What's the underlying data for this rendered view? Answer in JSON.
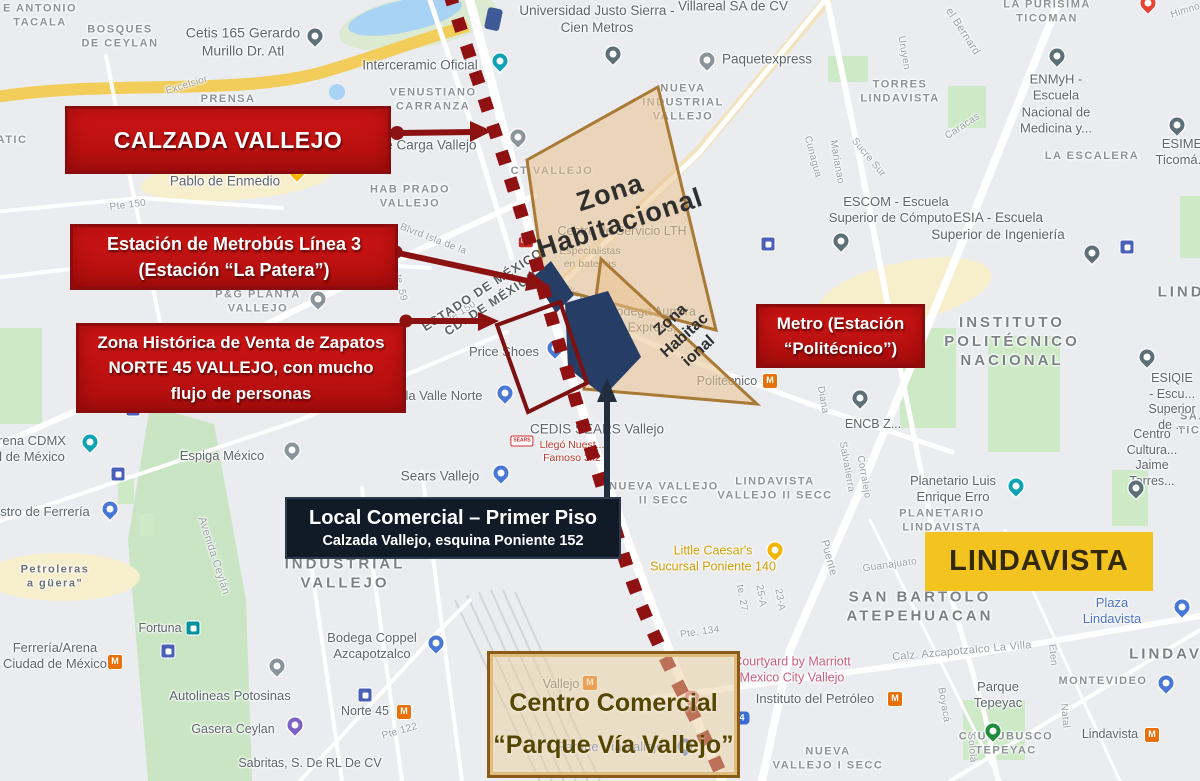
{
  "annotations": {
    "calzada_box": {
      "label": "CALZADA VALLEJO"
    },
    "metrobus_box": {
      "line1": "Estación de Metrobús Línea 3",
      "line2": "(Estación “La Patera”)"
    },
    "zona_historica_box": {
      "line1": "Zona Histórica de Venta de Zapatos",
      "line2": "NORTE 45 VALLEJO, con mucho",
      "line3": "flujo de personas"
    },
    "metro_box": {
      "line1": "Metro (Estación",
      "line2": "“Politécnico”)"
    },
    "local_box": {
      "line1": "Local Comercial – Primer Piso",
      "line2": "Calzada Vallejo, esquina Poniente 152"
    },
    "lindavista_box": {
      "label": "LINDAVISTA"
    },
    "centro_box": {
      "line1": "Centro Comercial",
      "line2": "“Parque Vía Vallejo”"
    },
    "zona_habitacional_1": "Zona\nHabitacional",
    "zona_habitacional_2": "Zona\nHabitac\nional"
  },
  "colors": {
    "callout_red": "#c01111",
    "callout_red_border": "#8a0c0c",
    "navy_box": "#111b28",
    "yellow_box": "#f3c41f",
    "zona_fill": "#e9c28f",
    "zona_border": "#a97a35",
    "dotted_line": "#8f1111",
    "station_blue": "#263d66",
    "metro_icon_orange": "#e8710a"
  },
  "map": {
    "labels": [
      {
        "t": "E ANTONIO\nTACALA",
        "x": 40,
        "y": 16,
        "k": "area"
      },
      {
        "t": "BOSQUES\nDE CEYLAN",
        "x": 120,
        "y": 37,
        "k": "area"
      },
      {
        "t": "ATIC",
        "x": 12,
        "y": 141,
        "k": "area"
      },
      {
        "t": "PRENSA",
        "x": 228,
        "y": 100,
        "k": "area"
      },
      {
        "t": "VENUSTIANO\nCARRANZA",
        "x": 433,
        "y": 100,
        "k": "area"
      },
      {
        "t": "HAB PRADO\nVALLEJO",
        "x": 410,
        "y": 197,
        "k": "area"
      },
      {
        "t": "CT VALLEJO",
        "x": 552,
        "y": 172,
        "k": "area"
      },
      {
        "t": "NUEVA\nINDUSTRIAL\nVALLEJO",
        "x": 683,
        "y": 103,
        "k": "area"
      },
      {
        "t": "TORRES\nLINDAVISTA",
        "x": 900,
        "y": 92,
        "k": "area"
      },
      {
        "t": "LA PURÍSIMA\nTICOMAN",
        "x": 1047,
        "y": 12,
        "k": "area"
      },
      {
        "t": "LA ESCALERA",
        "x": 1092,
        "y": 157,
        "k": "area"
      },
      {
        "t": "SA...\nTIC...",
        "x": 1196,
        "y": 424,
        "k": "area"
      },
      {
        "t": "LINDA",
        "x": 1188,
        "y": 293,
        "k": "area-lg"
      },
      {
        "t": "INSTITUTO\nPOLITÉCNICO\nNACIONAL",
        "x": 1012,
        "y": 342,
        "k": "area-lg"
      },
      {
        "t": "SAN BARTOLO\nATEPEHUACAN",
        "x": 920,
        "y": 607,
        "k": "area-lg"
      },
      {
        "t": "LINDAVISTA",
        "x": 1188,
        "y": 655,
        "k": "area-lg"
      },
      {
        "t": "INDUSTRIAL\nVALLEJO",
        "x": 345,
        "y": 574,
        "k": "area-lg"
      },
      {
        "t": "NUEVA VALLEJO\nII SECC",
        "x": 664,
        "y": 494,
        "k": "area"
      },
      {
        "t": "LINDAVISTA\nVALLEJO II SECC",
        "x": 775,
        "y": 489,
        "k": "area"
      },
      {
        "t": "PLANETARIO\nLINDAVISTA",
        "x": 942,
        "y": 521,
        "k": "area"
      },
      {
        "t": "MONTEVIDEO",
        "x": 1103,
        "y": 682,
        "k": "area"
      },
      {
        "t": "CHURUBUSCO\nTEPEYAC",
        "x": 1006,
        "y": 744,
        "k": "area"
      },
      {
        "t": "NUEVA\nVALLEJO I SECC",
        "x": 828,
        "y": 759,
        "k": "area"
      },
      {
        "t": "P&G PLANTA\nVALLEJO",
        "x": 258,
        "y": 302,
        "k": "area"
      },
      {
        "t": "Petroleras\na güera\"",
        "x": 55,
        "y": 577,
        "k": "area",
        "c": "#6d7276"
      },
      {
        "t": "Cetis 165 Gerardo\nMurillo Dr. Atl",
        "x": 243,
        "y": 42,
        "k": "poi",
        "s": 14
      },
      {
        "t": "Interceramic Oficial",
        "x": 420,
        "y": 66,
        "k": "poi",
        "s": 13.5
      },
      {
        "t": "Universidad Justo Sierra -\nCien Metros",
        "x": 597,
        "y": 20,
        "k": "poi",
        "s": 13.5
      },
      {
        "t": "Villareal SA de CV",
        "x": 733,
        "y": 7,
        "k": "poi",
        "s": 13.5
      },
      {
        "t": "Paquetexpress",
        "x": 767,
        "y": 60,
        "k": "poi",
        "s": 13.5
      },
      {
        "t": "ENMyH -\nEscuela\nNacional de\nMedicina y...",
        "x": 1056,
        "y": 104,
        "k": "poi",
        "s": 13
      },
      {
        "t": "ESIME\nTicomá...",
        "x": 1182,
        "y": 152,
        "k": "poi",
        "s": 13
      },
      {
        "t": "ESCOM - Escuela\nSuperior de Cómputo...",
        "x": 896,
        "y": 210,
        "k": "poi",
        "s": 13
      },
      {
        "t": "ESIA - Escuela\nSuperior de Ingeniería",
        "x": 998,
        "y": 227,
        "k": "poi",
        "s": 13.5
      },
      {
        "t": "ESIQIE - Escu...\nSuperior de ...",
        "x": 1172,
        "y": 402,
        "k": "poi",
        "s": 12.5
      },
      {
        "t": "Centro Cultura...\nJaime Torres...",
        "x": 1152,
        "y": 458,
        "k": "poi",
        "s": 12.5
      },
      {
        "t": "ENCB Z...",
        "x": 873,
        "y": 425,
        "k": "poi"
      },
      {
        "t": "Planetario Luis\nEnrique Erro",
        "x": 953,
        "y": 489,
        "k": "poi",
        "s": 13
      },
      {
        "t": "Little Caesar's\nSucursal Poniente 140",
        "x": 713,
        "y": 559,
        "k": "poi",
        "c": "#d29d00",
        "s": 12.5
      },
      {
        "t": "Plaza Lindavista",
        "x": 1112,
        "y": 611,
        "k": "poi",
        "c": "#4a73c9",
        "s": 13
      },
      {
        "t": "Parque\nTepeyac",
        "x": 998,
        "y": 695,
        "k": "poi",
        "s": 13
      },
      {
        "t": "Instituto del Petróleo",
        "x": 815,
        "y": 699,
        "k": "poi",
        "s": 13
      },
      {
        "t": "Courtyard by Marriott\nMexico City Vallejo",
        "x": 792,
        "y": 670,
        "k": "poi",
        "c": "#c75f82",
        "s": 12.5
      },
      {
        "t": "Lindavista",
        "x": 1110,
        "y": 735,
        "k": "poi",
        "s": 12.5
      },
      {
        "t": "Bodega Coppel\nAzcapotzalco",
        "x": 372,
        "y": 646,
        "k": "poi",
        "s": 13
      },
      {
        "t": "Norte 45",
        "x": 365,
        "y": 712,
        "k": "poi",
        "s": 12.5
      },
      {
        "t": "Sabritas, S. De RL De CV",
        "x": 310,
        "y": 764,
        "k": "poi",
        "s": 12.5
      },
      {
        "t": "Gasera Ceylan",
        "x": 233,
        "y": 730,
        "k": "poi",
        "s": 12.5
      },
      {
        "t": "Autolineas Potosinas",
        "x": 230,
        "y": 696,
        "k": "poi",
        "s": 13
      },
      {
        "t": "Fortuna",
        "x": 160,
        "y": 629,
        "k": "poi",
        "s": 12.5
      },
      {
        "t": "Espiga México",
        "x": 222,
        "y": 456,
        "k": "poi",
        "s": 13
      },
      {
        "t": "rena CDMX\nl de México",
        "x": 32,
        "y": 449,
        "k": "poi",
        "s": 13
      },
      {
        "t": "stro de Ferrería",
        "x": 45,
        "y": 512,
        "k": "poi",
        "s": 13
      },
      {
        "t": "Ferrería/Arena\nCiudad de México",
        "x": 55,
        "y": 656,
        "k": "poi",
        "s": 13
      },
      {
        "t": "Price Shoes",
        "x": 504,
        "y": 352,
        "k": "poi",
        "s": 13
      },
      {
        "t": "la Valle Norte",
        "x": 444,
        "y": 396,
        "k": "poi",
        "s": 13
      },
      {
        "t": "Bodega Aurrera\nExpress,",
        "x": 652,
        "y": 320,
        "k": "poi",
        "s": 12.5
      },
      {
        "t": "Centro de Servicio LTH",
        "x": 622,
        "y": 232,
        "k": "poi",
        "s": 12.5
      },
      {
        "t": "Especialistas\nen baterías",
        "x": 590,
        "y": 258,
        "k": "poi-sm"
      },
      {
        "t": "CEDIS SEARS Vallejo",
        "x": 597,
        "y": 430,
        "k": "poi",
        "s": 13.5
      },
      {
        "t": "Llegó Nuest...\nFamoso 3x2",
        "x": 572,
        "y": 452,
        "k": "poi-sm",
        "c": "#c0392b"
      },
      {
        "t": "Sears Vallejo",
        "x": 440,
        "y": 477,
        "k": "poi",
        "s": 13.5
      },
      {
        "t": "Pablo de Enmedio",
        "x": 225,
        "y": 182,
        "k": "poi",
        "s": 13.5
      },
      {
        "t": "al de Carga Vallejo",
        "x": 420,
        "y": 146,
        "k": "poi",
        "s": 13.5
      },
      {
        "t": "Politécnico",
        "x": 727,
        "y": 382,
        "k": "poi",
        "s": 12.5
      },
      {
        "t": "Vallejo",
        "x": 561,
        "y": 685,
        "k": "poi",
        "s": 12.5
      },
      {
        "t": "Parque Vía Vallejo",
        "x": 610,
        "y": 747,
        "k": "poi",
        "c": "#4a73c9",
        "s": 13
      },
      {
        "t": "Excelsior",
        "x": 187,
        "y": 86,
        "k": "street",
        "r": -17
      },
      {
        "t": "Pte 150",
        "x": 128,
        "y": 206,
        "k": "street",
        "r": -7
      },
      {
        "t": "Pte 150",
        "x": 460,
        "y": 314,
        "k": "street",
        "r": -33
      },
      {
        "t": "te. 59",
        "x": 400,
        "y": 288,
        "k": "street",
        "r": 77
      },
      {
        "t": "Blvrd Isla de la",
        "x": 433,
        "y": 240,
        "k": "street",
        "r": 21
      },
      {
        "t": "Avenida Ceylán",
        "x": 213,
        "y": 556,
        "k": "street",
        "r": 72,
        "s": 11
      },
      {
        "t": "el Bernard",
        "x": 962,
        "y": 32,
        "k": "street",
        "r": 57,
        "s": 11
      },
      {
        "t": "Uruyen",
        "x": 903,
        "y": 53,
        "k": "street",
        "r": 80
      },
      {
        "t": "Caracas",
        "x": 963,
        "y": 127,
        "k": "street",
        "r": -33
      },
      {
        "t": "Cunagua",
        "x": 812,
        "y": 157,
        "k": "street",
        "r": 75
      },
      {
        "t": "Marianao",
        "x": 836,
        "y": 162,
        "k": "street",
        "r": 80
      },
      {
        "t": "Sucre Sur",
        "x": 868,
        "y": 158,
        "k": "street",
        "r": 50
      },
      {
        "t": "Salvatierra",
        "x": 846,
        "y": 467,
        "k": "street",
        "r": 80
      },
      {
        "t": "Corralejo",
        "x": 863,
        "y": 477,
        "k": "street",
        "r": 80
      },
      {
        "t": "Puente",
        "x": 828,
        "y": 558,
        "k": "street",
        "r": 75,
        "s": 11
      },
      {
        "t": "Guanajuato",
        "x": 890,
        "y": 566,
        "k": "street",
        "r": -8
      },
      {
        "t": "Eten",
        "x": 1052,
        "y": 655,
        "k": "street",
        "r": 85
      },
      {
        "t": "Natal",
        "x": 1064,
        "y": 716,
        "k": "street",
        "r": 85
      },
      {
        "t": "Boyacá",
        "x": 943,
        "y": 705,
        "k": "street",
        "r": 80
      },
      {
        "t": "Sololá",
        "x": 971,
        "y": 748,
        "k": "street",
        "r": 85
      },
      {
        "t": "te. 27",
        "x": 741,
        "y": 598,
        "k": "street",
        "r": 80
      },
      {
        "t": "25-A",
        "x": 760,
        "y": 596,
        "k": "street",
        "r": 80
      },
      {
        "t": "23-A",
        "x": 779,
        "y": 600,
        "k": "street",
        "r": 80
      },
      {
        "t": "Pte. 134",
        "x": 700,
        "y": 633,
        "k": "street",
        "r": -8
      },
      {
        "t": "Pte 122",
        "x": 400,
        "y": 732,
        "k": "street",
        "r": -16
      },
      {
        "t": "Calz. Azcapotzalco La Villa",
        "x": 962,
        "y": 652,
        "k": "street",
        "r": -5,
        "s": 11
      },
      {
        "t": "Diana",
        "x": 822,
        "y": 400,
        "k": "street",
        "r": 80
      },
      {
        "t": "Playa",
        "x": 577,
        "y": 295,
        "k": "street",
        "r": 25
      },
      {
        "t": "Himno...",
        "x": 1190,
        "y": 10,
        "k": "street",
        "r": -18
      },
      {
        "t": "ESTADO DE MÉXICO\nCD. DE MÉXICO",
        "x": 487,
        "y": 297,
        "k": "boundary",
        "r": -33
      }
    ],
    "markers": [
      {
        "k": "pin",
        "c": "#5d7078",
        "x": 315,
        "y": 36,
        "n": "school-pin"
      },
      {
        "k": "pin",
        "c": "#5d7078",
        "x": 613,
        "y": 54,
        "n": "school-pin"
      },
      {
        "k": "pin",
        "c": "#5d7078",
        "x": 1057,
        "y": 56,
        "n": "school-pin"
      },
      {
        "k": "pin",
        "c": "#5d7078",
        "x": 1177,
        "y": 125,
        "n": "school-pin"
      },
      {
        "k": "pin",
        "c": "#5d7078",
        "x": 841,
        "y": 241,
        "n": "school-pin"
      },
      {
        "k": "pin",
        "c": "#5d7078",
        "x": 1092,
        "y": 253,
        "n": "school-pin"
      },
      {
        "k": "pin",
        "c": "#5d7078",
        "x": 1147,
        "y": 357,
        "n": "school-pin"
      },
      {
        "k": "pin",
        "c": "#5d7078",
        "x": 1136,
        "y": 488,
        "n": "school-pin"
      },
      {
        "k": "pin",
        "c": "#5d7078",
        "x": 860,
        "y": 398,
        "n": "school-pin"
      },
      {
        "k": "pin",
        "c": "#10a3b4",
        "x": 500,
        "y": 61,
        "n": "attraction-pin"
      },
      {
        "k": "pin",
        "c": "#10a3b4",
        "x": 90,
        "y": 442,
        "n": "attraction-pin"
      },
      {
        "k": "pin",
        "c": "#10a3b4",
        "x": 1016,
        "y": 486,
        "n": "attraction-pin"
      },
      {
        "k": "pin",
        "c": "#4877d6",
        "x": 555,
        "y": 348,
        "n": "shopping-pin"
      },
      {
        "k": "pin",
        "c": "#4877d6",
        "x": 505,
        "y": 393,
        "n": "shopping-pin"
      },
      {
        "k": "pin",
        "c": "#4877d6",
        "x": 501,
        "y": 473,
        "n": "shopping-pin"
      },
      {
        "k": "pin",
        "c": "#4877d6",
        "x": 436,
        "y": 643,
        "n": "shopping-pin"
      },
      {
        "k": "pin",
        "c": "#4877d6",
        "x": 1182,
        "y": 607,
        "n": "shopping-pin"
      },
      {
        "k": "pin",
        "c": "#4877d6",
        "x": 685,
        "y": 746,
        "n": "shopping-pin"
      },
      {
        "k": "pin",
        "c": "#4877d6",
        "x": 110,
        "y": 509,
        "n": "shopping-pin"
      },
      {
        "k": "pin",
        "c": "#4877d6",
        "x": 1166,
        "y": 683,
        "n": "shopping-pin"
      },
      {
        "k": "pin",
        "c": "#8a949b",
        "x": 318,
        "y": 299,
        "n": "place-pin"
      },
      {
        "k": "pin",
        "c": "#8a949b",
        "x": 707,
        "y": 60,
        "n": "place-pin"
      },
      {
        "k": "pin",
        "c": "#8a949b",
        "x": 292,
        "y": 450,
        "n": "place-pin"
      },
      {
        "k": "pin",
        "c": "#8a949b",
        "x": 277,
        "y": 666,
        "n": "place-pin"
      },
      {
        "k": "pin",
        "c": "#8a949b",
        "x": 518,
        "y": 137,
        "n": "place-pin"
      },
      {
        "k": "pin",
        "c": "#f4b400",
        "x": 297,
        "y": 171,
        "n": "food-pin"
      },
      {
        "k": "pin",
        "c": "#f4b400",
        "x": 775,
        "y": 550,
        "n": "food-pin"
      },
      {
        "k": "pin",
        "c": "#7b61c4",
        "x": 295,
        "y": 725,
        "n": "gas-pin"
      },
      {
        "k": "pin",
        "c": "#1e8e3e",
        "x": 993,
        "y": 731,
        "n": "park-pin"
      },
      {
        "k": "pin",
        "c": "#d06a7e",
        "x": 692,
        "y": 698,
        "n": "hotel-pin"
      },
      {
        "k": "pin",
        "c": "#ea4335",
        "x": 1148,
        "y": 3,
        "n": "red-pin"
      },
      {
        "k": "metro",
        "x": 115,
        "y": 662,
        "n": "metro-station-icon"
      },
      {
        "k": "metro",
        "x": 404,
        "y": 712,
        "n": "metro-station-icon"
      },
      {
        "k": "metro",
        "x": 770,
        "y": 381,
        "n": "metro-station-icon"
      },
      {
        "k": "metro",
        "x": 895,
        "y": 699,
        "n": "metro-station-icon"
      },
      {
        "k": "metro",
        "x": 1152,
        "y": 735,
        "n": "metro-station-icon"
      },
      {
        "k": "metro",
        "x": 590,
        "y": 683,
        "n": "metro-station-icon"
      },
      {
        "k": "train",
        "c": "#00929e",
        "x": 193,
        "y": 628,
        "n": "suburban-train-icon"
      },
      {
        "k": "train",
        "c": "#4a5fb8",
        "x": 133,
        "y": 409,
        "n": "transit-icon"
      },
      {
        "k": "train",
        "c": "#4a5fb8",
        "x": 118,
        "y": 474,
        "n": "transit-icon"
      },
      {
        "k": "train",
        "c": "#4a5fb8",
        "x": 168,
        "y": 651,
        "n": "transit-icon"
      },
      {
        "k": "train",
        "c": "#4a5fb8",
        "x": 365,
        "y": 695,
        "n": "transit-icon"
      },
      {
        "k": "train",
        "c": "#4a5fb8",
        "x": 768,
        "y": 244,
        "n": "transit-icon"
      },
      {
        "k": "train",
        "c": "#4a5fb8",
        "x": 1127,
        "y": 247,
        "n": "transit-icon"
      },
      {
        "k": "shield",
        "t": "4",
        "x": 742,
        "y": 718,
        "n": "route-shield"
      },
      {
        "k": "sears",
        "t": "SEARS",
        "x": 522,
        "y": 441,
        "n": "sears-logo"
      },
      {
        "k": "lth",
        "t": "LTH",
        "x": 526,
        "y": 242,
        "n": "lth-logo"
      }
    ]
  }
}
